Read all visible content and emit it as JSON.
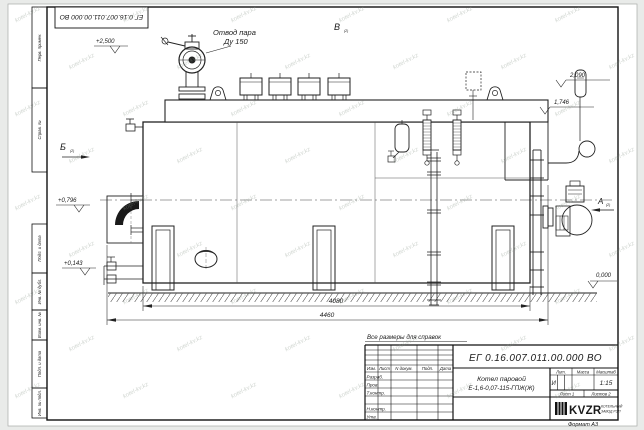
{
  "sheet": {
    "corner_stamp": "ЕГ 0.16.007.011.00.000  ВО",
    "format_label": "Формат А3",
    "reference_note": "Все размеры для справок"
  },
  "margin": {
    "boxes": [
      {
        "label": "Перв. примен."
      },
      {
        "label": "Справ. №"
      },
      {
        "label": "Подп. и дата"
      },
      {
        "label": "Инв. № дубл."
      },
      {
        "label": "Взам. инв. №"
      },
      {
        "label": "Подп. и дата"
      },
      {
        "label": "Инв. № подл."
      }
    ]
  },
  "drawing": {
    "callout_line1": "Отвод пара",
    "callout_line2": "Ду 150",
    "view_b": "Б",
    "view_v": "В",
    "view_a": "А",
    "view_sheet_ref": "(2)",
    "elev_valve": "+2,500",
    "elev_gauge": "2,090",
    "elev_drum": "1,746",
    "elev_mid": "+0,796",
    "elev_low": "+0,143",
    "elev_zero": "0,000",
    "dim_inner": "4080",
    "dim_overall": "4460"
  },
  "title_block": {
    "designation": "ЕГ 0.16.007.011.00.000  ВО",
    "name_line1": "Котел паровой",
    "name_line2": "Е-1,6-0,07-115-ГПЖ(Ж)",
    "col_izm": "Изм.",
    "col_list": "Лист",
    "col_doc": "N докум.",
    "col_podp": "Подп.",
    "col_data": "Дата",
    "row_razrab": "Разраб.",
    "row_prov": "Пров.",
    "row_tkontr": "Т.контр.",
    "row_nkontr": "Н.контр.",
    "row_utv": "Утв.",
    "lit_label": "Лит.",
    "mass_label": "Масса",
    "scale_label": "Масштаб",
    "lit_value": "И",
    "scale_value": "1:15",
    "sheet_label": "Лист 1",
    "sheets_label": "Листов 2",
    "logo_text": "KVZR",
    "company_line1": "КОТЕЛЬНЫЙ",
    "company_line2": "ЗАВОД РЭП"
  },
  "watermark": {
    "text": "kotel-kv.kz"
  }
}
